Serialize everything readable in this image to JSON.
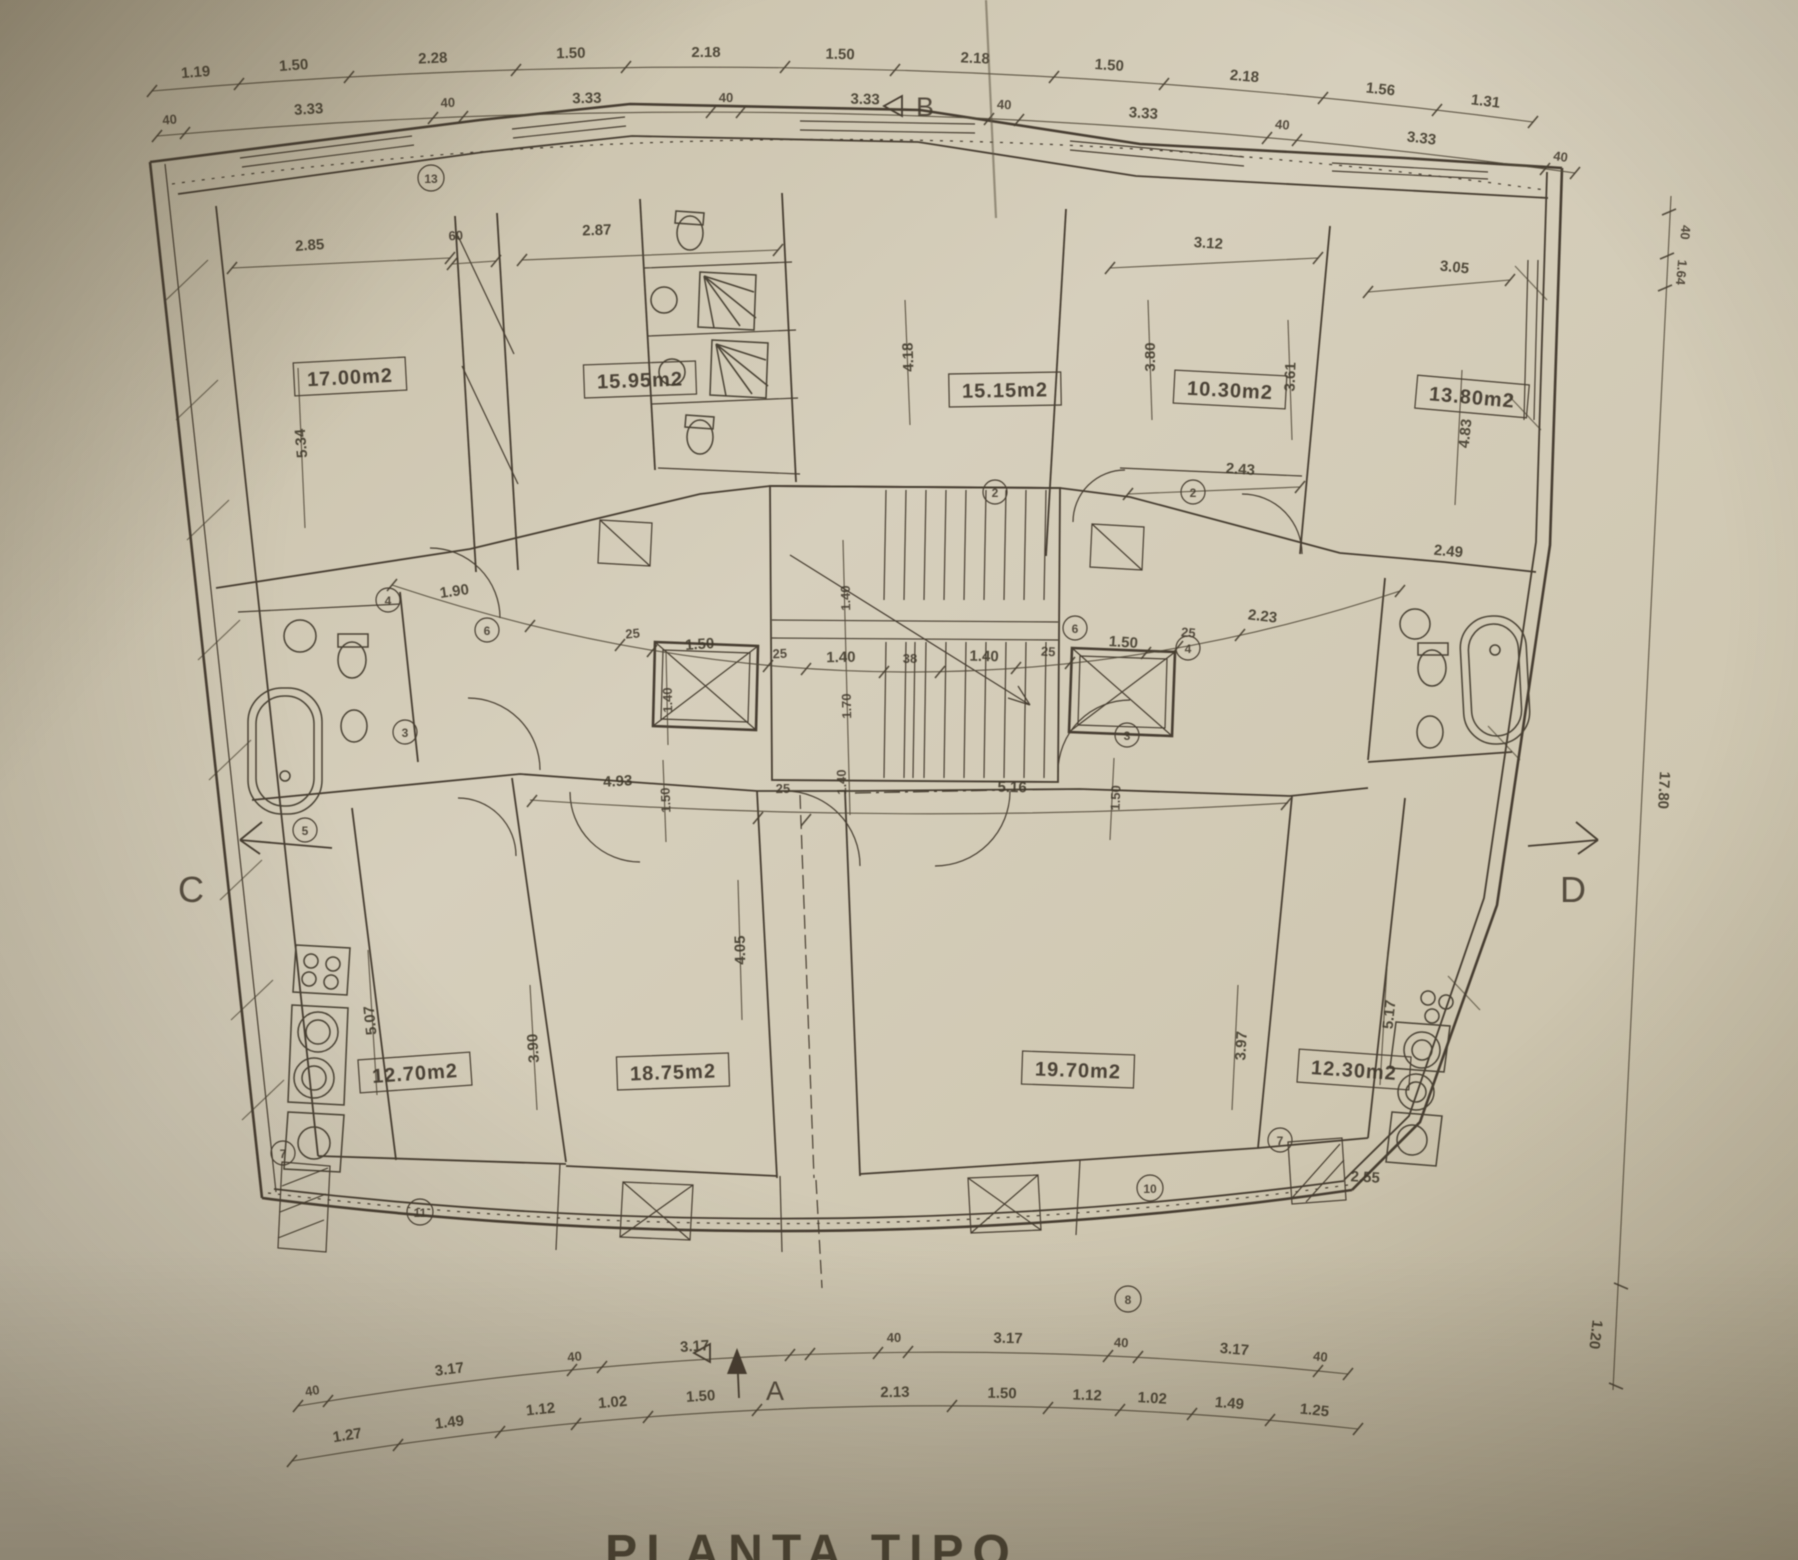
{
  "drawing_title": "PLANTA TIPO",
  "colors": {
    "paper": "#cfc7b1",
    "paper_edge": "#b4ab93",
    "ink": "#463e30"
  },
  "rooms": [
    {
      "name": "bedroom-top-left",
      "area": "17.00m2"
    },
    {
      "name": "bedroom-top-left-2",
      "area": "15.95m2"
    },
    {
      "name": "bedroom-top-center",
      "area": "15.15m2"
    },
    {
      "name": "room-top-right-2",
      "area": "10.30m2"
    },
    {
      "name": "bedroom-top-right",
      "area": "13.80m2"
    },
    {
      "name": "kitchen-bottom-left",
      "area": "12.70m2"
    },
    {
      "name": "living-bottom-left",
      "area": "18.75m2"
    },
    {
      "name": "living-bottom-right",
      "area": "19.70m2"
    },
    {
      "name": "kitchen-bottom-right",
      "area": "12.30m2"
    }
  ],
  "dims": {
    "top_outer": [
      "1.19",
      "1.50",
      "2.28",
      "1.50",
      "2.18",
      "1.50",
      "2.18",
      "1.50",
      "2.18",
      "1.56",
      "1.31"
    ],
    "top_inner": [
      "40",
      "3.33",
      "40",
      "3.33",
      "40",
      "3.33",
      "40",
      "3.33",
      "40",
      "3.33",
      "40"
    ],
    "bottom_inner": [
      "40",
      "3.17",
      "40",
      "3.17",
      "40",
      "3.17",
      "40",
      "3.17",
      "40"
    ],
    "bottom_outer": [
      "1.27",
      "1.49",
      "1.12",
      "1.02",
      "1.50",
      "2.13",
      "1.50",
      "1.12",
      "1.02",
      "1.49",
      "1.25"
    ],
    "core": [
      "1.90",
      "25",
      "1.50",
      "25",
      "1.40",
      "38",
      "1.40",
      "25",
      "1.50",
      "25",
      "2.23"
    ],
    "span": [
      "4.93",
      "25",
      "5.16"
    ],
    "interior": [
      "2.85",
      "60",
      "2.87",
      "3.12",
      "2.43",
      "3.05",
      "5.34",
      "4.18",
      "3.80",
      "3.61",
      "4.83",
      "5.07",
      "3.90",
      "4.05",
      "3.97",
      "5.17",
      "2.55",
      "1.40",
      "1.40",
      "1.70",
      "1.40",
      "1.50",
      "1.50",
      "2.49",
      "40",
      "1.64",
      "17.80",
      "1.20"
    ]
  },
  "section_markers": {
    "a": "A",
    "b": "B",
    "c": "C",
    "d": "D"
  },
  "refs": [
    "13",
    "2",
    "2",
    "4",
    "6",
    "6",
    "4",
    "3",
    "3",
    "5",
    "7",
    "7",
    "11",
    "10",
    "8"
  ]
}
